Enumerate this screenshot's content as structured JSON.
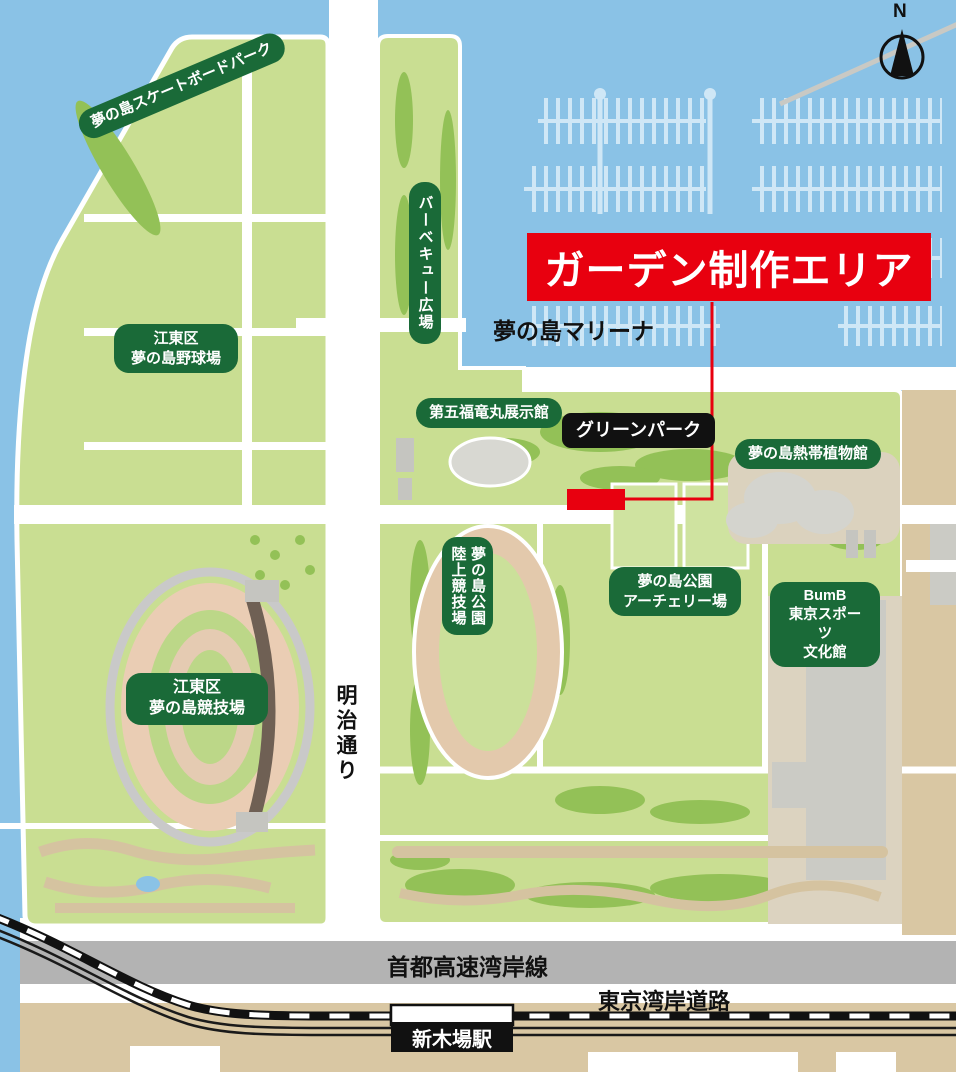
{
  "map": {
    "banner": {
      "text": "ガーデン制作エリア"
    },
    "labels": {
      "skatepark": "夢の島スケートボードパーク",
      "baseball": "江東区\n夢の島野球場",
      "bbq_plaza": "バーベキュー広場",
      "daigo_fukuryu_maru": "第五福竜丸展示館",
      "green_park": "グリーンパーク",
      "marina": "夢の島マリーナ",
      "tropical_dome": "夢の島熱帯植物館",
      "athletics_field": "夢の島公園\n陸上競技場",
      "archery_field": "夢の島公園\nアーチェリー場",
      "bumb": "BumB\n東京スポーツ\n文化館",
      "stadium": "江東区\n夢の島競技場",
      "meiji_dori": "明治通り",
      "expressway": "首都高速湾岸線",
      "wangan_road": "東京湾岸道路",
      "shinkiba_station": "新木場駅",
      "north_mark": "N"
    },
    "colors": {
      "water": "#8AC2E6",
      "land_green": "#C9DE92",
      "accent_green": "#93C157",
      "label_green": "#1A6A38",
      "label_black": "#111111",
      "highlight_red": "#E8000F",
      "road_white": "#FFFFFF",
      "expressway_gray": "#B3B3B3",
      "ground_tan": "#D9C7A3",
      "track_tan": "#EACDB4"
    }
  }
}
